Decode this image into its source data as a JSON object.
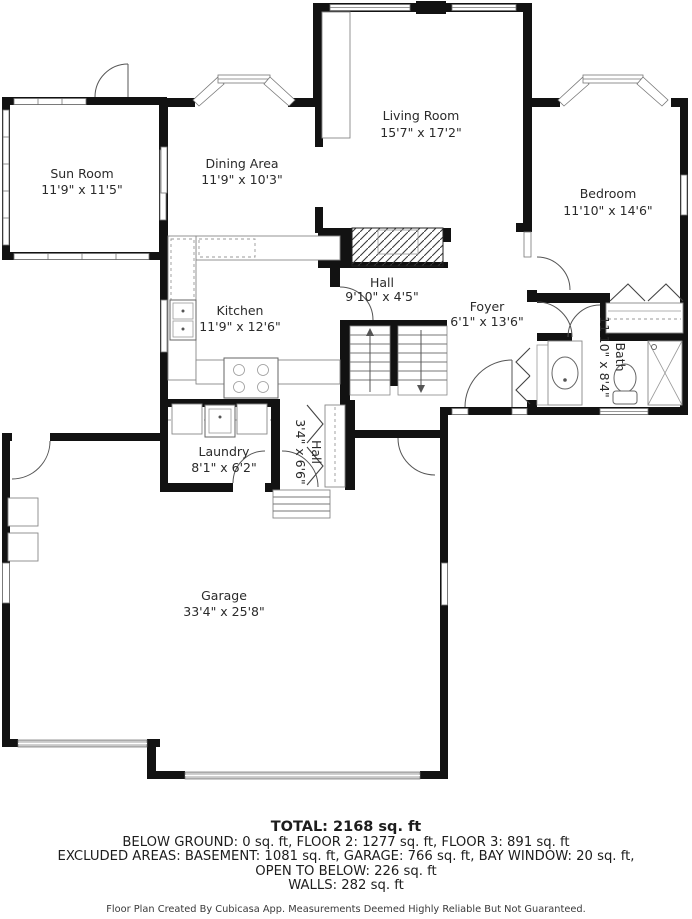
{
  "plan": {
    "rooms": [
      {
        "name": "Sun Room",
        "dims": "11'9\" x 11'5\""
      },
      {
        "name": "Dining Area",
        "dims": "11'9\" x 10'3\""
      },
      {
        "name": "Living Room",
        "dims": "15'7\" x 17'2\""
      },
      {
        "name": "Bedroom",
        "dims": "11'10\" x 14'6\""
      },
      {
        "name": "Kitchen",
        "dims": "11'9\" x 12'6\""
      },
      {
        "name": "Hall",
        "dims": "9'10\" x 4'5\""
      },
      {
        "name": "Foyer",
        "dims": "6'1\" x 13'6\""
      },
      {
        "name": "Bath",
        "dims": "11'10\" x 8'4\""
      },
      {
        "name": "Laundry",
        "dims": "8'1\" x 6'2\""
      },
      {
        "name": "Hall",
        "dims": "3'4\" x 6'6\""
      },
      {
        "name": "Garage",
        "dims": "33'4\" x 25'8\""
      }
    ]
  },
  "summary": {
    "total": "TOTAL: 2168 sq. ft",
    "line2": "BELOW GROUND: 0 sq. ft, FLOOR 2: 1277 sq. ft, FLOOR 3: 891 sq. ft",
    "line3": "EXCLUDED AREAS: BASEMENT: 1081 sq. ft, GARAGE: 766 sq. ft, BAY WINDOW: 20 sq. ft,",
    "line4": "OPEN TO BELOW: 226 sq. ft",
    "line5": "WALLS: 282 sq. ft"
  },
  "credit": "Floor Plan Created By Cubicasa App. Measurements Deemed Highly Reliable But Not Guaranteed."
}
